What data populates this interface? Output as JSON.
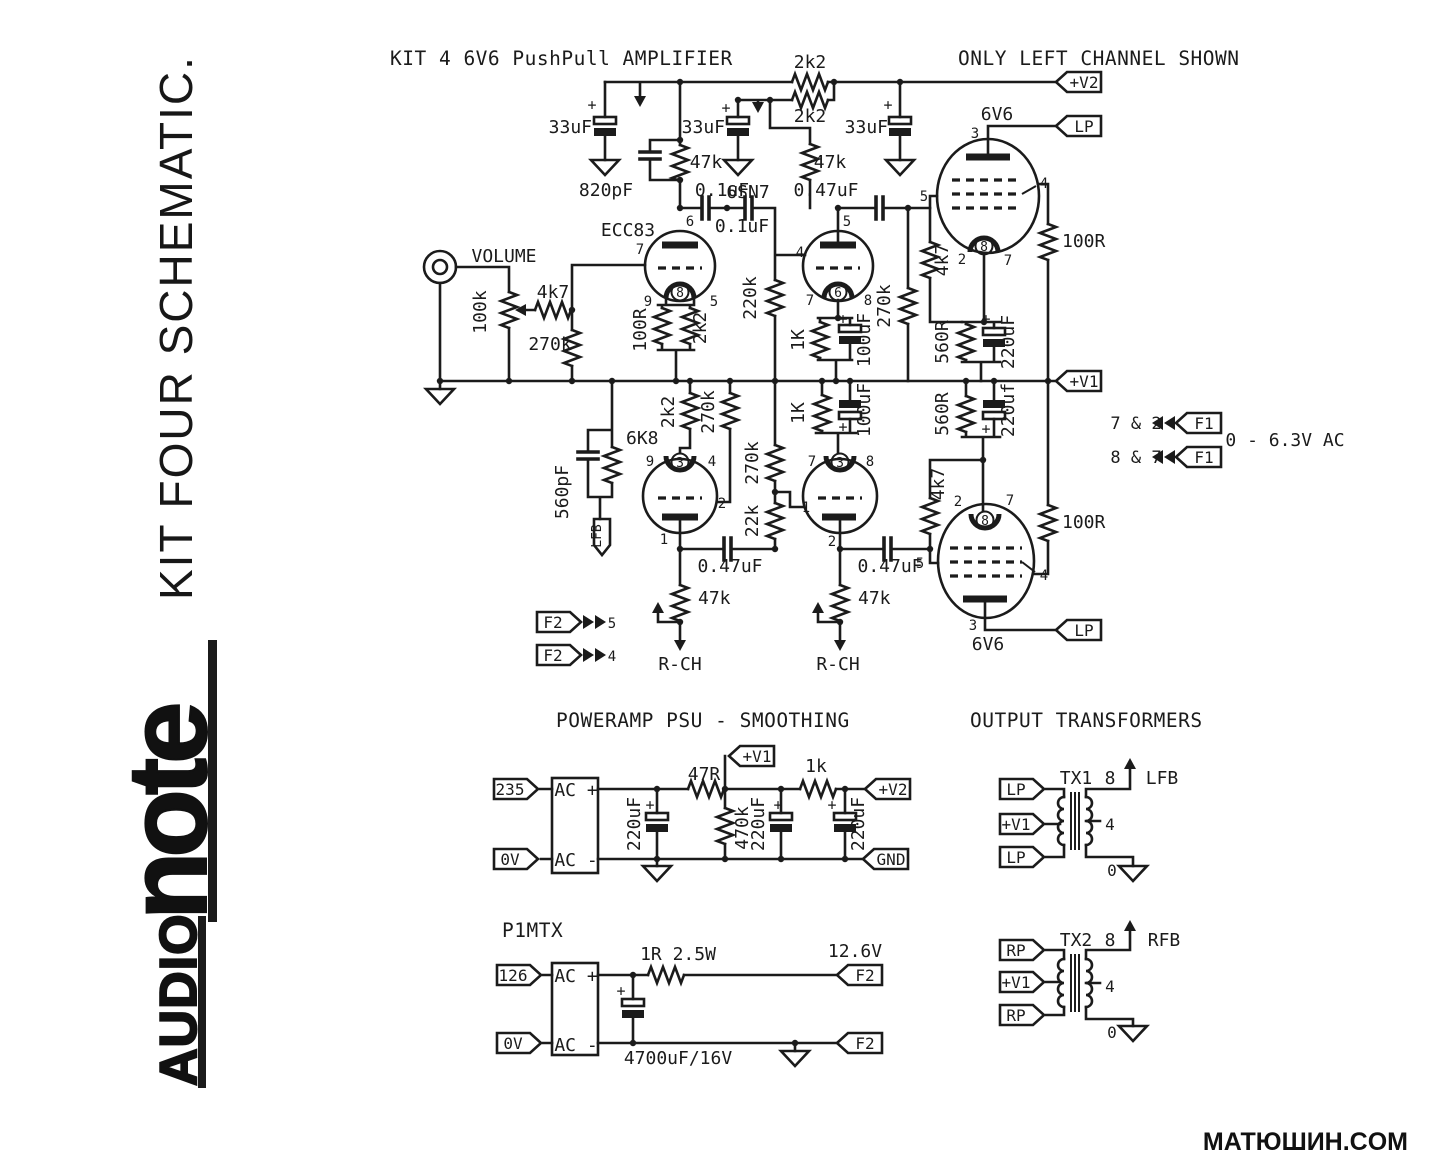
{
  "branding": {
    "logo_audio": "AUDIO",
    "logo_note": "note",
    "vertical_title": "KIT FOUR SCHEMATIC.",
    "watermark": "МАТЮШИН.COM"
  },
  "titles": {
    "main": "KIT 4 6V6 PushPull AMPLIFIER",
    "channel_note": "ONLY LEFT CHANNEL SHOWN",
    "psu": "POWERAMP PSU - SMOOTHING",
    "heater": "P1MTX",
    "output": "OUTPUT TRANSFORMERS"
  },
  "colors": {
    "ink": "#1b1b1b",
    "paper": "#ffffff"
  },
  "schematic": {
    "labels": [
      {
        "t": "2k2",
        "x": 810,
        "y": 68
      },
      {
        "t": "2k2",
        "x": 810,
        "y": 122
      },
      {
        "t": "33uF",
        "x": 592,
        "y": 133,
        "a": "end"
      },
      {
        "t": "+",
        "x": 592,
        "y": 110,
        "s": 15
      },
      {
        "t": "820pF",
        "x": 606,
        "y": 196
      },
      {
        "t": "47k",
        "x": 706,
        "y": 168
      },
      {
        "t": "0.1uF",
        "x": 722,
        "y": 196
      },
      {
        "t": "0.1uF",
        "x": 742,
        "y": 232
      },
      {
        "t": "6",
        "x": 690,
        "y": 226,
        "s": 14
      },
      {
        "t": "ECC83",
        "x": 628,
        "y": 236,
        "n": "tube-label-ecc83"
      },
      {
        "t": "7",
        "x": 640,
        "y": 254,
        "s": 14
      },
      {
        "t": "9",
        "x": 648,
        "y": 306,
        "s": 14
      },
      {
        "t": "5",
        "x": 714,
        "y": 306,
        "s": 14
      },
      {
        "t": "8",
        "x": 680,
        "y": 297,
        "s": 13
      },
      {
        "t": "100R",
        "x": 646,
        "y": 330,
        "r": 1
      },
      {
        "t": "2k2",
        "x": 706,
        "y": 328,
        "r": 1
      },
      {
        "t": "VOLUME",
        "x": 504,
        "y": 262,
        "n": "volume-label"
      },
      {
        "t": "100k",
        "x": 486,
        "y": 312,
        "r": 1
      },
      {
        "t": "4k7",
        "x": 553,
        "y": 298
      },
      {
        "t": "270k",
        "x": 550,
        "y": 350
      },
      {
        "t": "220k",
        "x": 756,
        "y": 298,
        "r": 1
      },
      {
        "t": "33uF",
        "x": 725,
        "y": 133,
        "a": "end"
      },
      {
        "t": "+",
        "x": 726,
        "y": 113,
        "s": 15
      },
      {
        "t": "6SN7",
        "x": 748,
        "y": 198,
        "n": "tube-label-6sn7"
      },
      {
        "t": "47k",
        "x": 830,
        "y": 168
      },
      {
        "t": "0.47uF",
        "x": 826,
        "y": 196
      },
      {
        "t": "5",
        "x": 847,
        "y": 226,
        "s": 14
      },
      {
        "t": "4",
        "x": 800,
        "y": 257,
        "s": 14
      },
      {
        "t": "7",
        "x": 810,
        "y": 305,
        "s": 14
      },
      {
        "t": "8",
        "x": 868,
        "y": 305,
        "s": 14
      },
      {
        "t": "6",
        "x": 838,
        "y": 297,
        "s": 13
      },
      {
        "t": "270k",
        "x": 890,
        "y": 306,
        "r": 1
      },
      {
        "t": "4k7",
        "x": 948,
        "y": 260,
        "r": 1
      },
      {
        "t": "1K",
        "x": 804,
        "y": 340,
        "r": 1
      },
      {
        "t": "+",
        "x": 843,
        "y": 324,
        "s": 15
      },
      {
        "t": "100uF",
        "x": 870,
        "y": 340,
        "r": 1
      },
      {
        "t": "560R",
        "x": 948,
        "y": 342,
        "r": 1
      },
      {
        "t": "+",
        "x": 986,
        "y": 324,
        "s": 15
      },
      {
        "t": "220uF",
        "x": 1014,
        "y": 342,
        "r": 1
      },
      {
        "t": "33uF",
        "x": 888,
        "y": 133,
        "a": "end"
      },
      {
        "t": "+",
        "x": 888,
        "y": 110,
        "s": 15
      },
      {
        "t": "3",
        "x": 975,
        "y": 138,
        "s": 14
      },
      {
        "t": "6V6",
        "x": 997,
        "y": 120,
        "n": "tube-label-6v6-top"
      },
      {
        "t": "5",
        "x": 924,
        "y": 201,
        "s": 14
      },
      {
        "t": "4",
        "x": 1044,
        "y": 188,
        "s": 14
      },
      {
        "t": "2",
        "x": 962,
        "y": 264,
        "s": 14
      },
      {
        "t": "7",
        "x": 1008,
        "y": 265,
        "s": 14
      },
      {
        "t": "8",
        "x": 984,
        "y": 251,
        "s": 13
      },
      {
        "t": "100R",
        "x": 1062,
        "y": 247,
        "a": "start"
      },
      {
        "t": "7 & 2",
        "x": 1136,
        "y": 429,
        "s": 17
      },
      {
        "t": "8 & 7",
        "x": 1136,
        "y": 463,
        "s": 17
      },
      {
        "t": "0 - 6.3V AC",
        "x": 1285,
        "y": 446
      },
      {
        "t": "6K8",
        "x": 626,
        "y": 444,
        "a": "start"
      },
      {
        "t": "560pF",
        "x": 568,
        "y": 492,
        "r": 1
      },
      {
        "t": "9",
        "x": 650,
        "y": 466,
        "s": 14
      },
      {
        "t": "4",
        "x": 712,
        "y": 466,
        "s": 14
      },
      {
        "t": "3",
        "x": 680,
        "y": 467,
        "s": 13
      },
      {
        "t": "2",
        "x": 722,
        "y": 508,
        "s": 14
      },
      {
        "t": "1",
        "x": 664,
        "y": 544,
        "s": 14
      },
      {
        "t": "2k2",
        "x": 674,
        "y": 412,
        "r": 1
      },
      {
        "t": "270k",
        "x": 714,
        "y": 412,
        "r": 1
      },
      {
        "t": "270k",
        "x": 758,
        "y": 463,
        "r": 1
      },
      {
        "t": "22k",
        "x": 758,
        "y": 521,
        "r": 1
      },
      {
        "t": "7",
        "x": 812,
        "y": 466,
        "s": 14
      },
      {
        "t": "8",
        "x": 870,
        "y": 466,
        "s": 14
      },
      {
        "t": "3",
        "x": 840,
        "y": 467,
        "s": 13
      },
      {
        "t": "1",
        "x": 806,
        "y": 512,
        "s": 14
      },
      {
        "t": "2",
        "x": 832,
        "y": 546,
        "s": 14
      },
      {
        "t": "1K",
        "x": 804,
        "y": 413,
        "r": 1
      },
      {
        "t": "100uF",
        "x": 870,
        "y": 410,
        "r": 1
      },
      {
        "t": "+",
        "x": 843,
        "y": 432,
        "s": 15
      },
      {
        "t": "560R",
        "x": 948,
        "y": 414,
        "r": 1
      },
      {
        "t": "220uf",
        "x": 1014,
        "y": 410,
        "r": 1
      },
      {
        "t": "+",
        "x": 986,
        "y": 434,
        "s": 15
      },
      {
        "t": "0.47uF",
        "x": 730,
        "y": 572
      },
      {
        "t": "0.47uF",
        "x": 890,
        "y": 572
      },
      {
        "t": "47k",
        "x": 698,
        "y": 604,
        "a": "start"
      },
      {
        "t": "47k",
        "x": 858,
        "y": 604,
        "a": "start"
      },
      {
        "t": "R-CH",
        "x": 680,
        "y": 670
      },
      {
        "t": "R-CH",
        "x": 838,
        "y": 670
      },
      {
        "t": "5",
        "x": 612,
        "y": 628,
        "s": 14
      },
      {
        "t": "4",
        "x": 612,
        "y": 661,
        "s": 14
      },
      {
        "t": "4k7",
        "x": 944,
        "y": 484,
        "r": 1
      },
      {
        "t": "2",
        "x": 958,
        "y": 506,
        "s": 14
      },
      {
        "t": "7",
        "x": 1010,
        "y": 505,
        "s": 14
      },
      {
        "t": "8",
        "x": 985,
        "y": 525,
        "s": 13
      },
      {
        "t": "5",
        "x": 920,
        "y": 568,
        "s": 14
      },
      {
        "t": "4",
        "x": 1044,
        "y": 580,
        "s": 14
      },
      {
        "t": "3",
        "x": 973,
        "y": 630,
        "s": 14
      },
      {
        "t": "6V6",
        "x": 988,
        "y": 650,
        "n": "tube-label-6v6-bottom"
      },
      {
        "t": "100R",
        "x": 1062,
        "y": 528,
        "a": "start"
      },
      {
        "t": "LFB",
        "x": 601,
        "y": 536,
        "r": 1,
        "s": 13
      },
      {
        "t": "AC +",
        "x": 576,
        "y": 796
      },
      {
        "t": "AC -",
        "x": 576,
        "y": 866
      },
      {
        "t": "220uF",
        "x": 640,
        "y": 824,
        "r": 1
      },
      {
        "t": "+",
        "x": 650,
        "y": 810,
        "s": 15
      },
      {
        "t": "47R",
        "x": 704,
        "y": 780
      },
      {
        "t": "470k",
        "x": 748,
        "y": 828,
        "r": 1
      },
      {
        "t": "220uF",
        "x": 764,
        "y": 824,
        "r": 1
      },
      {
        "t": "+",
        "x": 778,
        "y": 810,
        "s": 15
      },
      {
        "t": "1k",
        "x": 816,
        "y": 772
      },
      {
        "t": "220uF",
        "x": 864,
        "y": 824,
        "r": 1
      },
      {
        "t": "+",
        "x": 832,
        "y": 810,
        "s": 15
      },
      {
        "t": "AC +",
        "x": 576,
        "y": 982
      },
      {
        "t": "AC -",
        "x": 576,
        "y": 1051
      },
      {
        "t": "1R 2.5W",
        "x": 678,
        "y": 960
      },
      {
        "t": "12.6V",
        "x": 855,
        "y": 957
      },
      {
        "t": "+",
        "x": 621,
        "y": 996,
        "s": 15
      },
      {
        "t": "4700uF/16V",
        "x": 678,
        "y": 1064
      },
      {
        "t": "TX1",
        "x": 1076,
        "y": 784,
        "n": "transformer-label-tx1"
      },
      {
        "t": "8",
        "x": 1110,
        "y": 784
      },
      {
        "t": "LFB",
        "x": 1162,
        "y": 784
      },
      {
        "t": "4",
        "x": 1110,
        "y": 830,
        "s": 16
      },
      {
        "t": "0",
        "x": 1112,
        "y": 876,
        "s": 16
      },
      {
        "t": "TX2",
        "x": 1076,
        "y": 946,
        "n": "transformer-label-tx2"
      },
      {
        "t": "8",
        "x": 1110,
        "y": 946
      },
      {
        "t": "RFB",
        "x": 1164,
        "y": 946
      },
      {
        "t": "4",
        "x": 1110,
        "y": 992,
        "s": 16
      },
      {
        "t": "0",
        "x": 1112,
        "y": 1038,
        "s": 16
      }
    ],
    "flags": [
      {
        "t": "+V2",
        "x": 1056,
        "y": 82,
        "d": "l",
        "n": "flag-v2-plus"
      },
      {
        "t": "LP",
        "x": 1056,
        "y": 126,
        "d": "l",
        "n": "flag-lp-top"
      },
      {
        "t": "+V1",
        "x": 1056,
        "y": 381,
        "d": "l",
        "n": "flag-v1-plus"
      },
      {
        "t": "F1",
        "x": 1176,
        "y": 423,
        "d": "l",
        "n": "flag-f1-a"
      },
      {
        "t": "F1",
        "x": 1176,
        "y": 457,
        "d": "l",
        "n": "flag-f1-b"
      },
      {
        "t": "LP",
        "x": 1056,
        "y": 630,
        "d": "l",
        "n": "flag-lp-bottom"
      },
      {
        "t": "F2",
        "x": 537,
        "y": 622,
        "d": "r",
        "n": "flag-f2-5"
      },
      {
        "t": "F2",
        "x": 537,
        "y": 655,
        "d": "r",
        "n": "flag-f2-4"
      },
      {
        "t": "235",
        "x": 494,
        "y": 789,
        "d": "r",
        "n": "flag-235"
      },
      {
        "t": "0V",
        "x": 494,
        "y": 859,
        "d": "r",
        "n": "flag-0v-psu"
      },
      {
        "t": "+V1",
        "x": 729,
        "y": 756,
        "d": "l",
        "n": "flag-v1-psu"
      },
      {
        "t": "+V2",
        "x": 865,
        "y": 789,
        "d": "l",
        "n": "flag-v2-psu"
      },
      {
        "t": "GND",
        "x": 863,
        "y": 859,
        "d": "l",
        "n": "flag-gnd"
      },
      {
        "t": "126",
        "x": 497,
        "y": 975,
        "d": "r",
        "n": "flag-126"
      },
      {
        "t": "0V",
        "x": 497,
        "y": 1043,
        "d": "r",
        "n": "flag-0v-heater"
      },
      {
        "t": "F2",
        "x": 837,
        "y": 975,
        "d": "l",
        "n": "flag-f2-heater-a"
      },
      {
        "t": "F2",
        "x": 837,
        "y": 1043,
        "d": "l",
        "n": "flag-f2-heater-b"
      },
      {
        "t": "LP",
        "x": 1000,
        "y": 789,
        "d": "r",
        "n": "flag-lp-tx1-a"
      },
      {
        "t": "+V1",
        "x": 1000,
        "y": 824,
        "d": "r",
        "n": "flag-v1-tx1"
      },
      {
        "t": "LP",
        "x": 1000,
        "y": 857,
        "d": "r",
        "n": "flag-lp-tx1-b"
      },
      {
        "t": "RP",
        "x": 1000,
        "y": 950,
        "d": "r",
        "n": "flag-rp-tx2-a"
      },
      {
        "t": "+V1",
        "x": 1000,
        "y": 982,
        "d": "r",
        "n": "flag-v1-tx2"
      },
      {
        "t": "RP",
        "x": 1000,
        "y": 1015,
        "d": "r",
        "n": "flag-rp-tx2-b"
      }
    ]
  }
}
